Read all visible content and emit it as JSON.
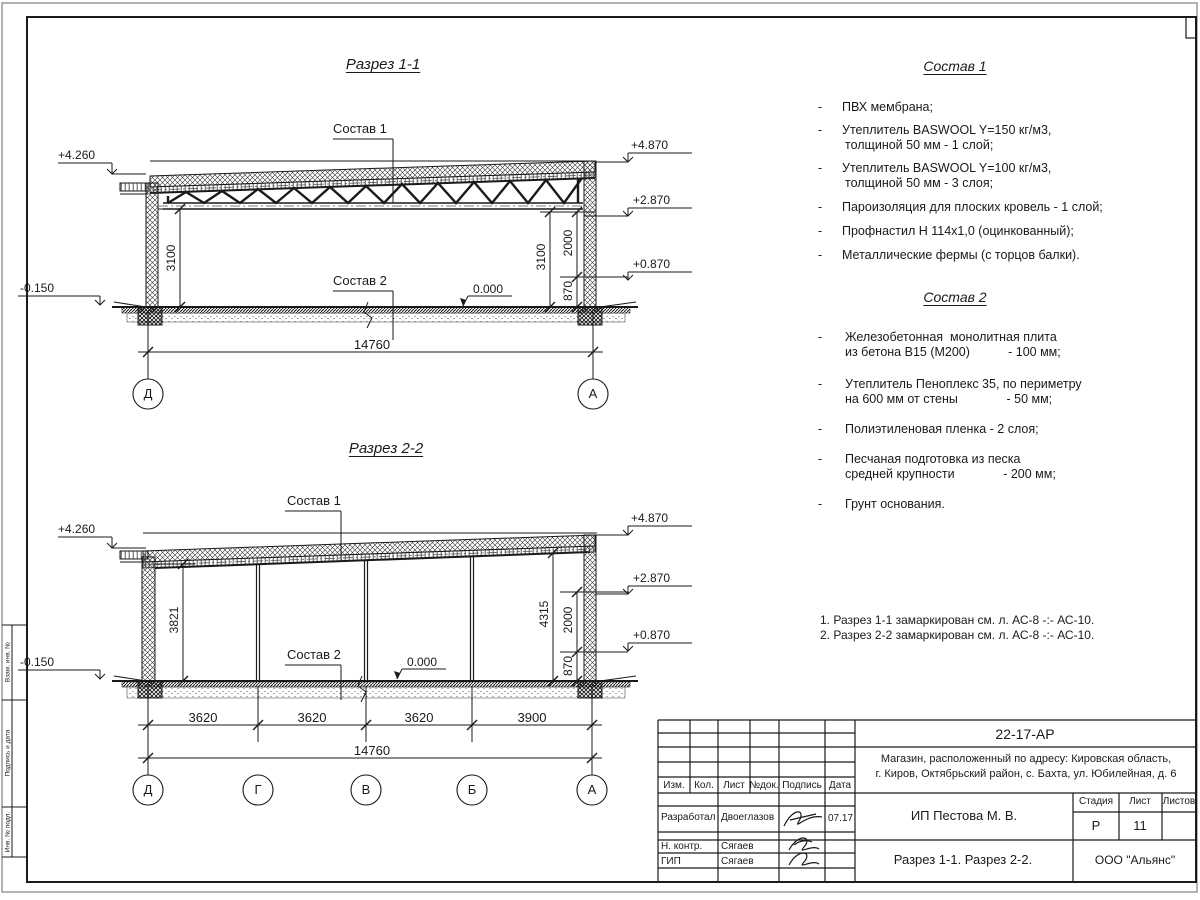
{
  "s1": {
    "title": "Разрез 1-1",
    "sostav1": "Состав 1",
    "sostav2": "Состав 2",
    "elev": {
      "l1": "+4.260",
      "l2": "-0.150",
      "r1": "+4.870",
      "r2": "+2.870",
      "r3": "+0.870",
      "zero": "0.000"
    },
    "dims": {
      "left": "3100",
      "r1": "3100",
      "r2": "2000",
      "r3": "870",
      "total": "14760"
    },
    "axes": [
      "Д",
      "А"
    ]
  },
  "s2": {
    "title": "Разрез 2-2",
    "sostav1": "Состав 1",
    "sostav2": "Состав 2",
    "elev": {
      "l1": "+4.260",
      "l2": "-0.150",
      "r1": "+4.870",
      "r2": "+2.870",
      "r3": "+0.870",
      "zero": "0.000"
    },
    "dims": {
      "left": "3821",
      "r1": "4315",
      "r2": "2000",
      "r3": "870",
      "total": "14760",
      "bays": [
        "3620",
        "3620",
        "3620",
        "3900"
      ]
    },
    "axes": [
      "Д",
      "Г",
      "В",
      "Б",
      "А"
    ]
  },
  "c1": {
    "title": "Состав 1",
    "marker": "-",
    "items": [
      [
        "ПВХ мембрана;"
      ],
      [
        "Утеплитель BASWOOL Y=150 кг/м3,",
        "толщиной 50 мм - 1 слой;"
      ],
      [
        "Утеплитель BASWOOL Y=100 кг/м3,",
        "толщиной 50 мм - 3 слоя;"
      ],
      [
        "Пароизоляция для плоских кровель - 1 слой;"
      ],
      [
        "Профнастил Н 114х1,0 (оцинкованный);"
      ],
      [
        "Металлические фермы (с торцов балки)."
      ]
    ]
  },
  "c2": {
    "title": "Состав 2",
    "marker": "-",
    "items": [
      [
        "Железобетонная  монолитная плита",
        "из бетона В15 (М200)           - 100 мм;"
      ],
      [
        "Утеплитель Пеноплекс 35, по периметру",
        "на 600 мм от стены              - 50 мм;"
      ],
      [
        "Полиэтиленовая пленка - 2 слоя;"
      ],
      [
        "Песчаная подготовка из песка",
        "средней крупности              - 200 мм;"
      ],
      [
        "Грунт основания."
      ]
    ]
  },
  "notes": [
    "1. Разрез 1-1 замаркирован см. л. АС-8 -:- АС-10.",
    "2. Разрез 2-2 замаркирован см. л. АС-8 -:- АС-10."
  ],
  "tb": {
    "doc": "22-17-АР",
    "obj1": "Магазин, расположенный по адресу: Кировская область,",
    "obj2": "г. Киров, Октябрьский район, с. Бахта, ул. Юбилейная, д. 6",
    "h": {
      "izm": "Изм.",
      "kol": "Кол.",
      "list": "Лист",
      "ndok": "№док.",
      "sign": "Подпись",
      "date": "Дата"
    },
    "r1": {
      "role": "Разработал",
      "name": "Двоеглазов",
      "date": "07.17"
    },
    "r2": {
      "role": "Н. контр.",
      "name": "Сягаев"
    },
    "r3": {
      "role": "ГИП",
      "name": "Сягаев"
    },
    "client": "ИП Пестова М. В.",
    "stage_l": "Стадия",
    "sheet_l": "Лист",
    "sheets_l": "Листов",
    "stage": "Р",
    "sheet": "11",
    "name": "Разрез 1-1. Разрез 2-2.",
    "org": "ООО \"Альянс\""
  },
  "strip": [
    "Взам. инв. №",
    "Подпись и дата",
    "Инв. № подл."
  ]
}
